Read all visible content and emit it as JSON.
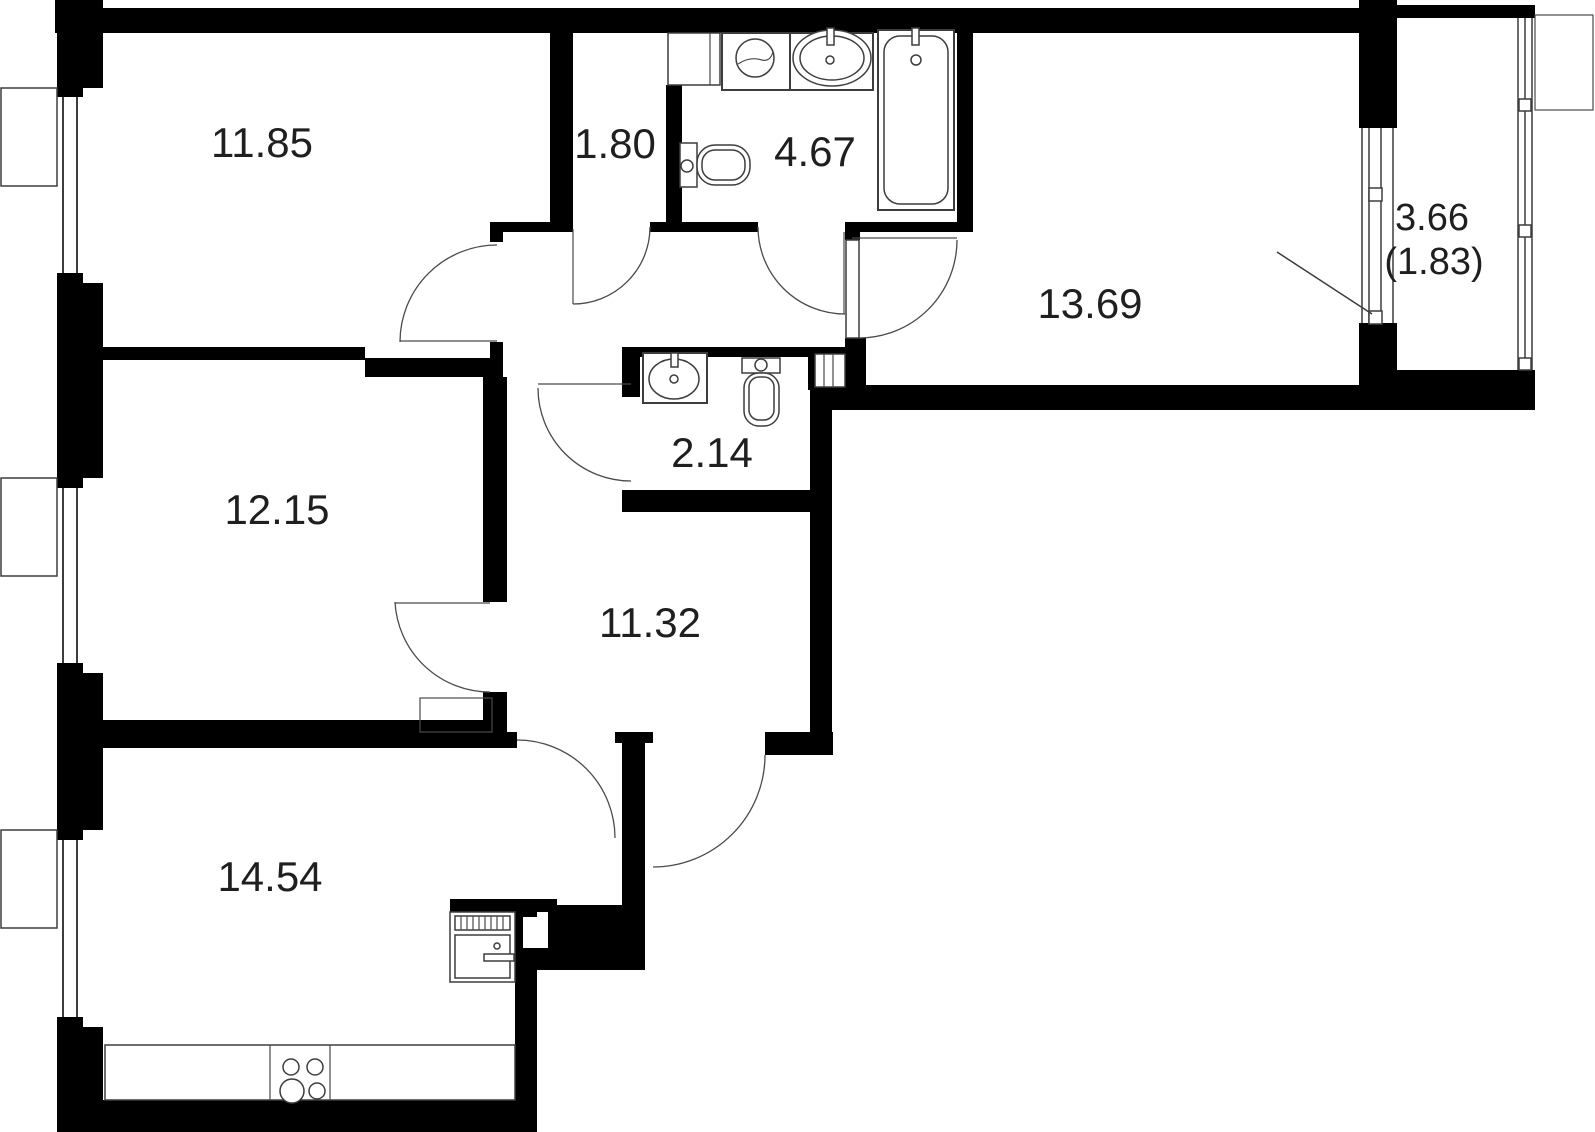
{
  "plan": {
    "type": "apartment-floor-plan",
    "units_hint": "room areas in square meters",
    "rooms": [
      {
        "name": "bedroom-top-left",
        "area": "11.85"
      },
      {
        "name": "closet-hall",
        "area": "1.80"
      },
      {
        "name": "bathroom",
        "area": "4.67"
      },
      {
        "name": "bedroom-right",
        "area": "13.69"
      },
      {
        "name": "balcony",
        "area": "3.66",
        "area_coefficient": "(1.83)"
      },
      {
        "name": "bedroom-left",
        "area": "12.15"
      },
      {
        "name": "wc",
        "area": "2.14"
      },
      {
        "name": "hallway",
        "area": "11.32"
      },
      {
        "name": "kitchen-living-room",
        "area": "14.54"
      }
    ],
    "colors": {
      "wall": "#000000",
      "line": "#3d3d3d",
      "background": "#ffffff",
      "text": "#1f1f1f"
    },
    "icons": [
      "bathtub-icon",
      "bathroom-sink-icon",
      "washing-machine-icon",
      "toilet-icon",
      "wc-sink-icon",
      "stove-burners-icon",
      "kitchen-counter-icon",
      "kitchen-appliance-icon",
      "vent-shaft-icon",
      "window-icon",
      "door-swing-icon",
      "balcony-glazing-icon"
    ]
  }
}
